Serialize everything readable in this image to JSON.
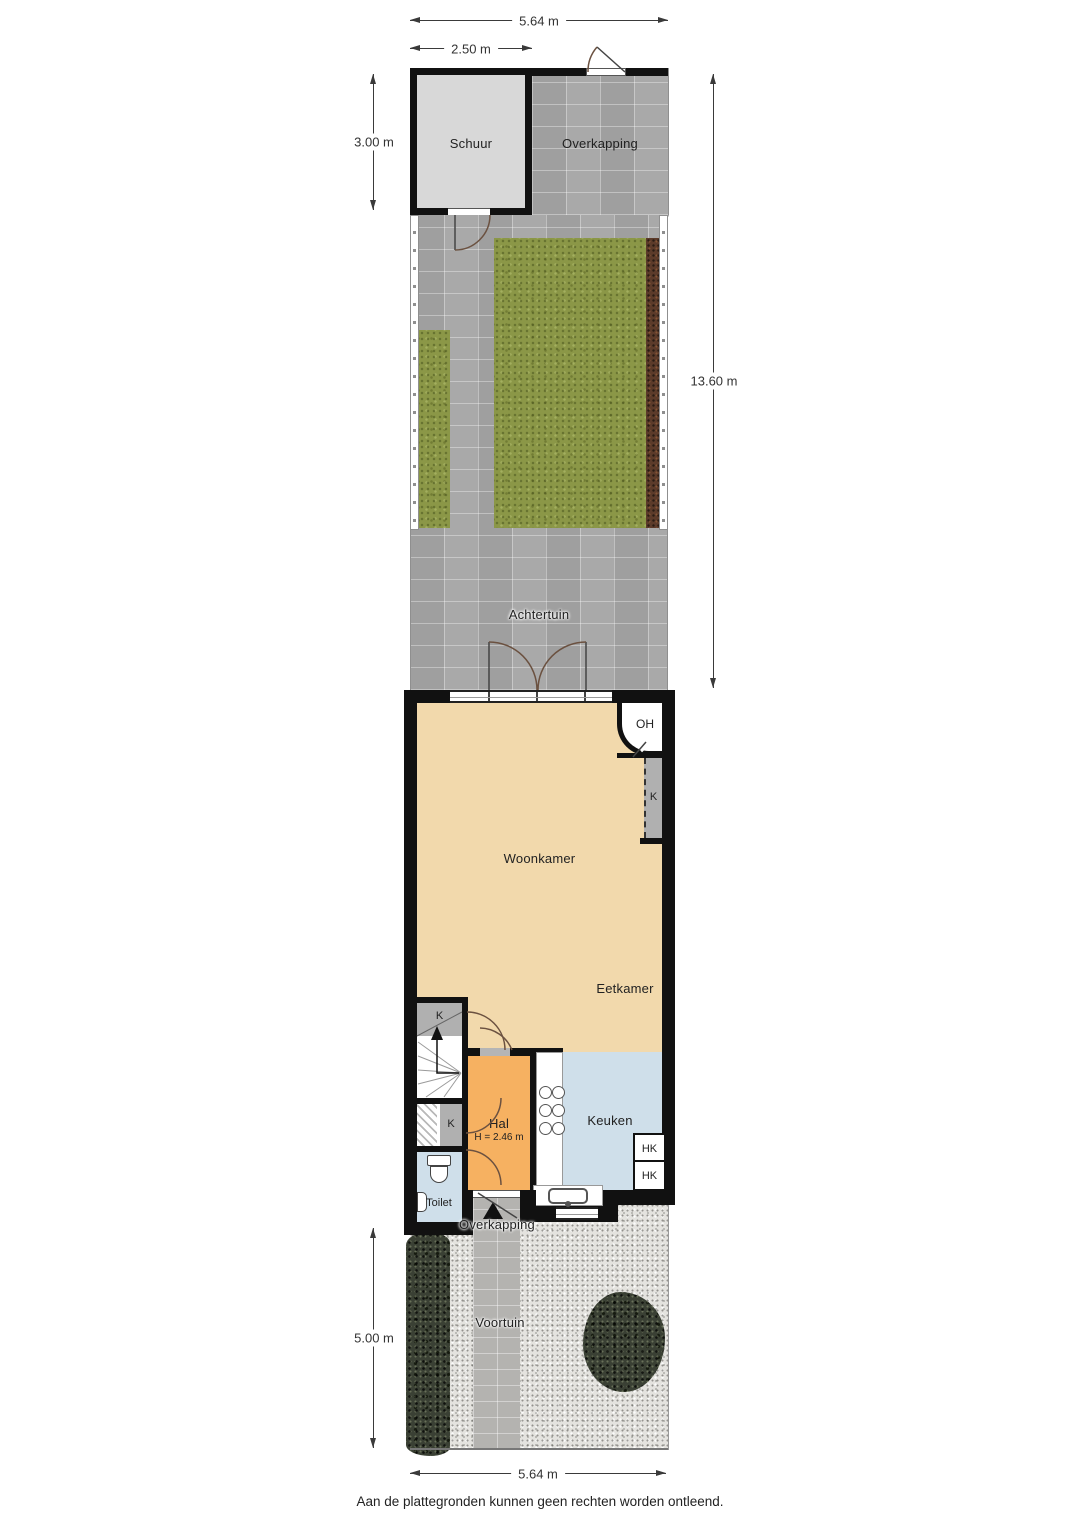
{
  "annotations": {
    "dim_top_total": "5.64 m",
    "dim_top_schuur": "2.50 m",
    "dim_schuur_height": "3.00 m",
    "dim_garden_height": "13.60 m",
    "dim_voortuin_height": "5.00 m",
    "dim_bottom_total": "5.64 m",
    "disclaimer": "Aan de plattegronden kunnen geen rechten worden ontleend."
  },
  "rooms": {
    "schuur": "Schuur",
    "overkapping": "Overkapping",
    "achtertuin": "Achtertuin",
    "woonkamer": "Woonkamer",
    "eetkamer": "Eetkamer",
    "hal": "Hal",
    "hal_ceiling_height": "H = 2.46 m",
    "keuken": "Keuken",
    "toilet": "Toilet",
    "voortuin": "Voortuin",
    "overkapping_entry": "Overkapping"
  },
  "markers": {
    "oh": "OH",
    "kast": "K",
    "hk": "HK"
  },
  "colors": {
    "wall": "#111111",
    "living_floor": "#F2D9AC",
    "hall_floor": "#F6B161",
    "kitchen_floor": "#CFDFEA",
    "closet": "#B0B0B0",
    "shed_floor": "#D8D8D8",
    "paving": "#A9A9A9",
    "grass": "#8B9747",
    "soil": "#5C3B2A",
    "gravel": "#E4E3DF",
    "hedge": "#3A4034"
  }
}
